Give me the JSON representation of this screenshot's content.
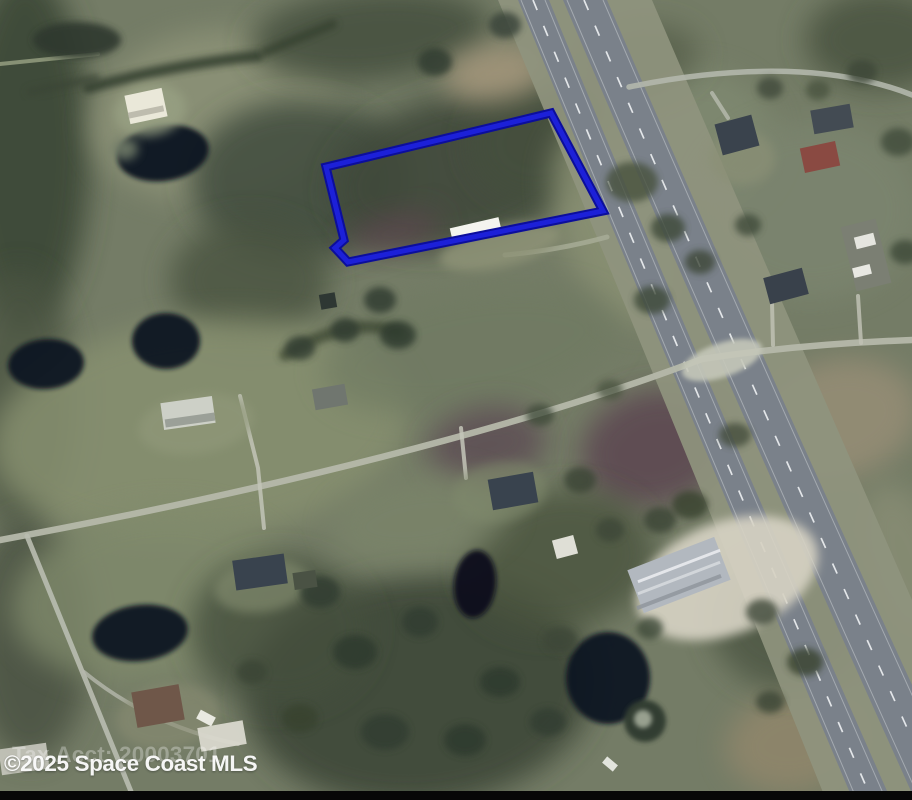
{
  "image": {
    "kind": "MLS aerial satellite listing photo",
    "width_px": 912,
    "height_px": 800
  },
  "watermark": {
    "text": "©2025 Space Coast MLS"
  },
  "tax_label": {
    "text": "Tax Acct: 20003701"
  },
  "palette": {
    "base": "#747c66",
    "water": "#0d1422",
    "asphalt": "#7a818a",
    "shoulder": "#8f947e",
    "local_road": "#b5b8aa",
    "lane_dash": "#eef1f3",
    "parcel_blue": "#1c20d8",
    "black_bar": "#070707"
  },
  "parcel": {
    "label": "outlined property boundary",
    "color_outer": "#0c0e9b",
    "color_inner": "#1c20d8",
    "stroke_width_outer": 9,
    "stroke_width_inner": 5,
    "points": [
      [
        326,
        167
      ],
      [
        551,
        113
      ],
      [
        603,
        211
      ],
      [
        348,
        262
      ],
      [
        335,
        248
      ],
      [
        344,
        240
      ]
    ]
  },
  "highway": {
    "shoulder": {
      "d": "M 498,0 L 652,0 Q 806,360 1000,800 L 826,800 Q 642,342 498,0 Z",
      "fill": "#8f947e",
      "opacity": 0.92
    },
    "roadways": [
      {
        "name": "highway-southbound-roadway",
        "d": "M 518,0 L 549,0 Q 691,348 891,800 L 853,800 Q 660,345 518,0 Z",
        "fill": "#7a818a"
      },
      {
        "name": "highway-northbound-roadway",
        "d": "M 563,0 L 607,0 Q 760,356 965,800 L 915,800 Q 713,352 563,0 Z",
        "fill": "#7a818a"
      }
    ],
    "edge_lines": [
      {
        "d": "M 521,0 Q 663,345 857,800"
      },
      {
        "d": "M 545,0 Q 687,347 886,800"
      },
      {
        "d": "M 567,0 Q 717,352 920,800"
      },
      {
        "d": "M 603,0 Q 756,355 960,800"
      }
    ],
    "lane_dashes": [
      {
        "d": "M 533,0 Q 675,346 872,800"
      },
      {
        "d": "M 584,0 Q 736,354 940,800"
      }
    ],
    "dash_color": "#eef1f3",
    "edge_color": "#d7dbde"
  },
  "terrain": {
    "format": [
      "cx",
      "cy",
      "rx",
      "ry",
      "rot",
      "fill",
      "opacity"
    ],
    "items": [
      [
        25,
        150,
        65,
        180,
        0,
        "#3e4839",
        0.95
      ],
      [
        20,
        400,
        55,
        130,
        0,
        "#4b5443",
        0.8
      ],
      [
        30,
        640,
        60,
        120,
        0,
        "#46503f",
        0.8
      ],
      [
        215,
        115,
        125,
        85,
        -8,
        "#8c9277",
        0.9
      ],
      [
        370,
        35,
        120,
        45,
        -5,
        "#47513f",
        0.9
      ],
      [
        300,
        180,
        110,
        80,
        0,
        "#414b3c",
        0.85
      ],
      [
        460,
        170,
        130,
        75,
        -13,
        "#3f493b",
        0.9
      ],
      [
        540,
        140,
        70,
        60,
        -13,
        "#454f3e",
        0.8
      ],
      [
        250,
        280,
        80,
        60,
        0,
        "#49533f",
        0.8
      ],
      [
        495,
        73,
        52,
        28,
        -8,
        "#a3957a",
        0.9
      ],
      [
        615,
        225,
        55,
        105,
        -21,
        "#8a9173",
        0.85
      ],
      [
        700,
        140,
        75,
        70,
        0,
        "#7f8971",
        0.85
      ],
      [
        810,
        210,
        110,
        90,
        0,
        "#7c856f",
        0.8
      ],
      [
        880,
        40,
        75,
        50,
        0,
        "#49523f",
        0.85
      ],
      [
        200,
        430,
        210,
        110,
        -6,
        "#87906f",
        0.85
      ],
      [
        470,
        350,
        150,
        60,
        -10,
        "#6f7a62",
        0.7
      ],
      [
        655,
        448,
        75,
        58,
        -15,
        "#5a4350",
        0.8
      ],
      [
        487,
        445,
        60,
        38,
        -10,
        "#57414f",
        0.65
      ],
      [
        395,
        232,
        48,
        18,
        -13,
        "#5d4450",
        0.7
      ],
      [
        835,
        420,
        85,
        60,
        -15,
        "#9b9078",
        0.75
      ],
      [
        150,
        595,
        140,
        85,
        -8,
        "#808a6c",
        0.8
      ],
      [
        420,
        690,
        175,
        115,
        -5,
        "#3d4737",
        0.9
      ],
      [
        280,
        630,
        90,
        75,
        0,
        "#45503e",
        0.8
      ],
      [
        560,
        560,
        95,
        70,
        -10,
        "#49533e",
        0.8
      ],
      [
        795,
        742,
        70,
        50,
        -10,
        "#93876c",
        0.8
      ],
      [
        790,
        620,
        80,
        70,
        0,
        "#4b5542",
        0.8
      ],
      [
        420,
        520,
        90,
        45,
        -8,
        "#7b856a",
        0.7
      ],
      [
        640,
        60,
        60,
        35,
        -10,
        "#525c46",
        0.7
      ],
      [
        905,
        560,
        40,
        80,
        -18,
        "#8c9077",
        0.7
      ]
    ]
  },
  "hedges": [
    {
      "name": "tree-hedge-row",
      "d": "M 88,88 Q 175,64 258,56",
      "w": 11,
      "c": "#313c2e",
      "o": 0.85
    },
    {
      "name": "tree-hedge-row",
      "d": "M 265,52 L 333,24",
      "w": 9,
      "c": "#35402f",
      "o": 0.8
    },
    {
      "name": "tree-hedge-row",
      "d": "M 96,78 L 30,92",
      "w": 8,
      "c": "#3a4534",
      "o": 0.7
    },
    {
      "name": "tree-hedge-row",
      "d": "M 285,355 Q 350,315 398,332",
      "w": 12,
      "c": "#37422f",
      "o": 0.7
    }
  ],
  "ponds": {
    "format": [
      "cx",
      "cy",
      "rx",
      "ry",
      "rot",
      "fill",
      "opacity"
    ],
    "items": [
      [
        163,
        153,
        46,
        28,
        -8,
        "#0d1422",
        0.96
      ],
      [
        46,
        364,
        38,
        25,
        -4,
        "#0c1320",
        0.95
      ],
      [
        166,
        341,
        34,
        28,
        0,
        "#0d1524",
        0.95
      ],
      [
        475,
        584,
        21,
        34,
        6,
        "#0a111e",
        0.95
      ],
      [
        140,
        633,
        48,
        28,
        -7,
        "#0c1422",
        0.95
      ],
      [
        608,
        678,
        42,
        46,
        0,
        "#0b1220",
        0.95
      ]
    ]
  },
  "roads": [
    {
      "name": "road-east-west",
      "d": "M 0,540 C 260,492 520,428 702,359 Q 800,344 912,340",
      "w": 6.5,
      "c": "#b5b8aa",
      "o": 0.95
    },
    {
      "name": "road-top-right",
      "d": "M 629,87 Q 720,68 800,72 Q 865,76 912,95",
      "w": 5.5,
      "c": "#b3b7ac",
      "o": 0.9
    },
    {
      "name": "driveway-bottom-left",
      "d": "M 27,536 L 132,794",
      "w": 5,
      "c": "#b9bcb0",
      "o": 0.9
    },
    {
      "name": "driveway-spur",
      "d": "M 84,672 Q 150,726 238,744",
      "w": 4,
      "c": "#b5b8ac",
      "o": 0.8
    },
    {
      "name": "driveway",
      "d": "M 240,396 L 258,468 L 264,528",
      "w": 4,
      "c": "#c2c4b7",
      "o": 0.85
    },
    {
      "name": "driveway",
      "d": "M 461,428 L 466,478",
      "w": 4,
      "c": "#c4c6b9",
      "o": 0.85
    },
    {
      "name": "driveway",
      "d": "M 772,302 L 773,345",
      "w": 4,
      "c": "#bfc1b4",
      "o": 0.85
    },
    {
      "name": "driveway",
      "d": "M 858,296 L 861,343",
      "w": 4,
      "c": "#bfc1b4",
      "o": 0.85
    },
    {
      "name": "parcel-access-path",
      "d": "M 505,255 Q 560,250 607,237",
      "w": 5,
      "c": "#a9ae98",
      "o": 0.8
    },
    {
      "name": "driveway",
      "d": "M 712,93 L 728,118",
      "w": 4,
      "c": "#b8bbaf",
      "o": 0.8
    },
    {
      "name": "path-top-left",
      "d": "M 0,64 L 98,54",
      "w": 4,
      "c": "#9aa284",
      "o": 0.8
    }
  ],
  "pads": {
    "format": [
      "cx",
      "cy",
      "rx",
      "ry",
      "rot",
      "fill",
      "opacity"
    ],
    "items": [
      [
        727,
        578,
        95,
        56,
        -21,
        "#d6d2c3",
        0.92
      ],
      [
        500,
        247,
        62,
        20,
        -13,
        "#8e9377",
        0.85
      ],
      [
        742,
        158,
        33,
        27,
        0,
        "#8b9076",
        0.7
      ],
      [
        262,
        586,
        48,
        26,
        -8,
        "#848d6f",
        0.65
      ],
      [
        168,
        716,
        52,
        32,
        -8,
        "#898c72",
        0.6
      ],
      [
        150,
        110,
        36,
        26,
        -10,
        "#99a284",
        0.75
      ],
      [
        196,
        424,
        58,
        30,
        -8,
        "#909879",
        0.7
      ],
      [
        125,
        149,
        13,
        11,
        0,
        "#6f7a68",
        0.9
      ],
      [
        500,
        492,
        48,
        30,
        -10,
        "#7f896c",
        0.6
      ]
    ]
  },
  "trees": {
    "format": [
      "cx",
      "cy",
      "rx",
      "ry",
      "rot",
      "fill",
      "opacity"
    ],
    "items": [
      [
        77,
        40,
        44,
        18,
        0,
        "#2d382f",
        0.9
      ],
      [
        435,
        62,
        17,
        14,
        0,
        "#323d30",
        0.85
      ],
      [
        505,
        25,
        16,
        13,
        0,
        "#3a453a",
        0.85
      ],
      [
        380,
        300,
        16,
        13,
        0,
        "#333e31",
        0.85
      ],
      [
        345,
        330,
        14,
        12,
        0,
        "#323d30",
        0.85
      ],
      [
        300,
        348,
        15,
        12,
        0,
        "#333e31",
        0.8
      ],
      [
        398,
        335,
        18,
        14,
        0,
        "#2f3a2e",
        0.85
      ],
      [
        632,
        182,
        26,
        20,
        0,
        "#46513e",
        0.8
      ],
      [
        668,
        228,
        17,
        14,
        0,
        "#3e4939",
        0.8
      ],
      [
        700,
        262,
        15,
        12,
        0,
        "#3c4737",
        0.8
      ],
      [
        652,
        300,
        18,
        14,
        0,
        "#3e4939",
        0.8
      ],
      [
        748,
        225,
        13,
        11,
        0,
        "#414c3b",
        0.8
      ],
      [
        770,
        88,
        13,
        11,
        0,
        "#3f4a3a",
        0.8
      ],
      [
        862,
        72,
        15,
        12,
        0,
        "#3c4737",
        0.8
      ],
      [
        898,
        142,
        17,
        14,
        0,
        "#414c3b",
        0.8
      ],
      [
        905,
        252,
        15,
        12,
        0,
        "#3e4939",
        0.8
      ],
      [
        818,
        90,
        12,
        10,
        0,
        "#46513e",
        0.75
      ],
      [
        660,
        520,
        16,
        13,
        0,
        "#3a4536",
        0.8
      ],
      [
        610,
        530,
        14,
        12,
        0,
        "#3c4737",
        0.8
      ],
      [
        690,
        505,
        18,
        14,
        0,
        "#37422f",
        0.8
      ],
      [
        580,
        480,
        16,
        13,
        0,
        "#3a4536",
        0.8
      ],
      [
        735,
        435,
        16,
        12,
        0,
        "#414a37",
        0.75
      ],
      [
        540,
        415,
        14,
        11,
        0,
        "#3e4939",
        0.75
      ],
      [
        610,
        390,
        13,
        10,
        0,
        "#46513e",
        0.7
      ],
      [
        320,
        592,
        20,
        16,
        0,
        "#333e31",
        0.85
      ],
      [
        355,
        652,
        22,
        17,
        0,
        "#2f3a2e",
        0.85
      ],
      [
        420,
        622,
        18,
        15,
        0,
        "#333e31",
        0.85
      ],
      [
        465,
        740,
        21,
        16,
        0,
        "#2f3a2e",
        0.85
      ],
      [
        385,
        732,
        24,
        18,
        0,
        "#333e31",
        0.85
      ],
      [
        300,
        718,
        18,
        14,
        0,
        "#37422f",
        0.8
      ],
      [
        500,
        682,
        20,
        15,
        0,
        "#2f3a2e",
        0.85
      ],
      [
        548,
        722,
        18,
        14,
        0,
        "#333e31",
        0.8
      ],
      [
        252,
        672,
        15,
        12,
        0,
        "#3a4536",
        0.8
      ],
      [
        762,
        612,
        16,
        13,
        0,
        "#3c4737",
        0.8
      ],
      [
        805,
        662,
        18,
        14,
        0,
        "#37422f",
        0.8
      ],
      [
        770,
        702,
        14,
        11,
        0,
        "#3a4536",
        0.8
      ],
      [
        560,
        640,
        17,
        13,
        0,
        "#3c4737",
        0.8
      ],
      [
        650,
        628,
        13,
        11,
        0,
        "#3e4939",
        0.8
      ]
    ]
  },
  "buildings": {
    "format": [
      "cx",
      "cy",
      "w",
      "h",
      "rot",
      "fill",
      "opacity"
    ],
    "items": [
      [
        476,
        231,
        50,
        17,
        -13,
        "#f4f4ee",
        1
      ],
      [
        679,
        575,
        93,
        46,
        -21,
        "#b2b8bf",
        1
      ],
      [
        679,
        566,
        88,
        3,
        -21,
        "#e9ebee",
        0.9
      ],
      [
        679,
        578,
        88,
        3,
        -21,
        "#dfe2e6",
        0.7
      ],
      [
        679,
        592,
        90,
        4,
        -21,
        "#8d939b",
        0.8
      ],
      [
        737,
        135,
        38,
        32,
        -15,
        "#3a434d",
        1
      ],
      [
        832,
        119,
        40,
        24,
        -10,
        "#434b53",
        1
      ],
      [
        820,
        157,
        36,
        25,
        -12,
        "#8a4a42",
        1
      ],
      [
        786,
        286,
        40,
        27,
        -15,
        "#39414b",
        1
      ],
      [
        866,
        255,
        36,
        66,
        -14,
        "#7b7f73",
        1
      ],
      [
        865,
        241,
        20,
        12,
        -14,
        "#e5e5df",
        1
      ],
      [
        862,
        271,
        18,
        10,
        -14,
        "#e8e8e2",
        1
      ],
      [
        188,
        413,
        52,
        27,
        -8,
        "#cdd0c7",
        1
      ],
      [
        190,
        420,
        50,
        8,
        -8,
        "#8e938c",
        0.8
      ],
      [
        330,
        397,
        33,
        21,
        -10,
        "#70766f",
        1
      ],
      [
        328,
        301,
        16,
        15,
        -10,
        "#2e3733",
        1
      ],
      [
        513,
        491,
        46,
        31,
        -10,
        "#39434e",
        1
      ],
      [
        565,
        547,
        22,
        19,
        -15,
        "#dfdfd6",
        1
      ],
      [
        260,
        572,
        52,
        30,
        -8,
        "#39434e",
        1
      ],
      [
        305,
        580,
        23,
        17,
        -8,
        "#4a5244",
        1
      ],
      [
        158,
        706,
        48,
        36,
        -10,
        "#6f5749",
        1
      ],
      [
        206,
        718,
        17,
        10,
        28,
        "#e9e9e1",
        1
      ],
      [
        222,
        736,
        46,
        24,
        -10,
        "#d9d8ce",
        0.95
      ],
      [
        24,
        759,
        48,
        26,
        -8,
        "#c8c8be",
        0.9
      ],
      [
        146,
        106,
        38,
        29,
        -12,
        "#eae8d9",
        1
      ],
      [
        146,
        112,
        36,
        6,
        -12,
        "#b9b7a8",
        0.9
      ],
      [
        610,
        764,
        14,
        8,
        40,
        "#eef0ea",
        0.9
      ]
    ]
  },
  "special": {
    "intersection_pad": [
      722,
      360,
      42,
      17,
      -19,
      "#c5c7b9",
      0.9
    ],
    "ring_tree": {
      "cx": 645,
      "cy": 721,
      "r_outer": 21,
      "r_inner": 9,
      "outer": "#333e33",
      "inner": "#98a08f"
    },
    "black_bar": {
      "y": 791,
      "h": 9
    }
  }
}
